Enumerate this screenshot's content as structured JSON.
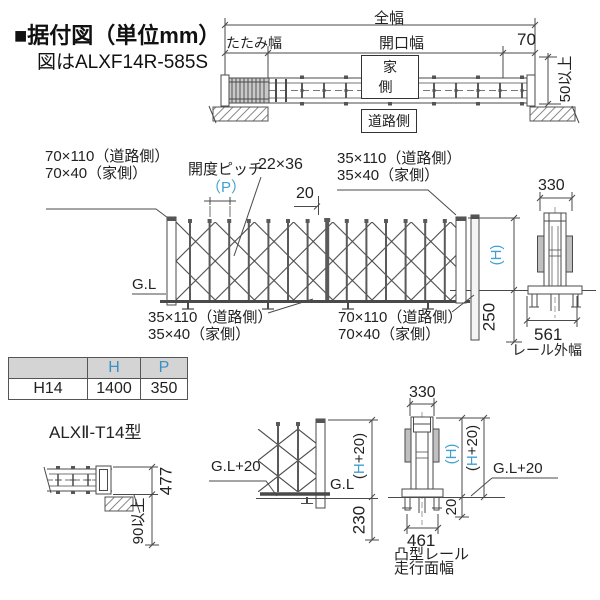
{
  "title": {
    "bullet": "■",
    "text": "据付図（単位mm）",
    "subtitle": "図はALXF14R-585S"
  },
  "colors": {
    "accent": "#3fa0d2",
    "line": "#4a4a4a",
    "text": "#222222",
    "table_header_bg": "#d4d4d4"
  },
  "top_view": {
    "total_width": "全幅",
    "fold_width": "たたみ幅",
    "opening_width": "開口幅",
    "dim_70": "70",
    "house_side": "家側",
    "road_side": "道路側",
    "clearance": "50以上"
  },
  "mid_view": {
    "label_70_110": "70×110（道路側）",
    "label_70_40": "70×40（家側）",
    "pitch_label": "開度ピッチ",
    "pitch_p": "（P）",
    "crossbar_size": "22×36",
    "dim_20": "20",
    "label_35_110": "35×110（道路側）",
    "label_35_40": "35×40（家側）",
    "gl": "G.L",
    "h": "(H)",
    "dim_250": "250",
    "side_dim_330": "330",
    "side_dim_561": "561",
    "rail_outer_label": "レール外幅"
  },
  "spec_table": {
    "headers": [
      "",
      "H",
      "P"
    ],
    "row": [
      "H14",
      "1400",
      "350"
    ]
  },
  "model_label": "ALXⅡ-T14型",
  "bottom_left_view": {
    "dim_477": "477",
    "dim_90": "90以上"
  },
  "bottom_mid_view": {
    "gl20": "G.L+20",
    "gl": "G.L",
    "h20_open": "(",
    "h20_h": "H",
    "h20_rest": "+20)",
    "dim_230": "230"
  },
  "bottom_right_view": {
    "dim_330": "330",
    "h": "(H)",
    "h20_open": "(",
    "h20_h": "H",
    "h20_rest": "+20)",
    "gl20": "G.L+20",
    "dim_20": "20",
    "dim_461": "461",
    "rail_label_1": "凸型レール",
    "rail_label_2": "走行面幅"
  }
}
